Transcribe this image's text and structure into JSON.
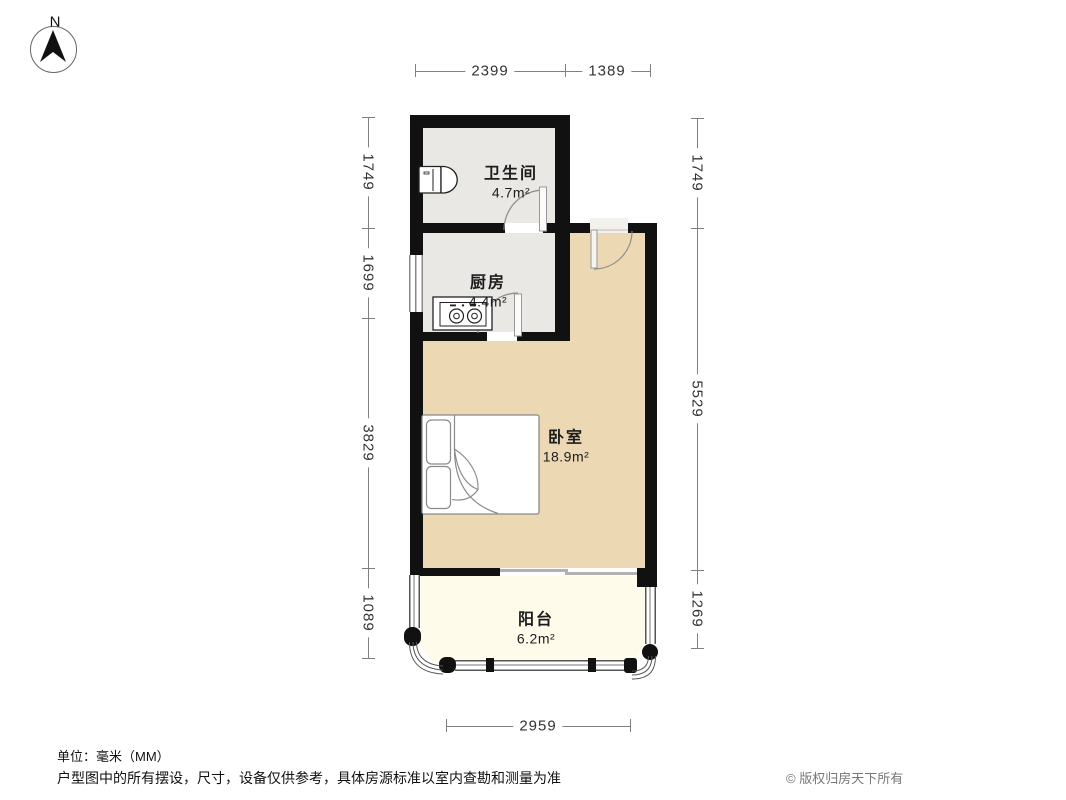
{
  "compass": {
    "north_label": "N"
  },
  "plan": {
    "rooms": [
      {
        "name": "卫生间",
        "area": "4.7m²"
      },
      {
        "name": "厨房",
        "area": "4.4m²"
      },
      {
        "name": "卧室",
        "area": "18.9m²"
      },
      {
        "name": "阳台",
        "area": "6.2m²"
      }
    ],
    "fixtures": [
      "toilet",
      "stove",
      "double-bed"
    ],
    "doors": [
      "bathroom-door",
      "kitchen-door",
      "entrance-door",
      "balcony-sliding-door"
    ]
  },
  "dimensions": {
    "unit": "mm",
    "top": [
      "2399",
      "1389"
    ],
    "left": [
      "1749",
      "1699",
      "3829",
      "1089"
    ],
    "right": [
      "1749",
      "5529",
      "1269"
    ],
    "bottom": [
      "2959"
    ]
  },
  "footer": {
    "unit_note": "单位：毫米（MM）",
    "disclaimer": "户型图中的所有摆设，尺寸，设备仅供参考，具体房源标准以室内查勘和测量为准",
    "copyright": "© 版权归房天下所有"
  },
  "colors": {
    "wall": "#111111",
    "bathroom_floor": "#e9e8e5",
    "kitchen_floor": "#e9e8e5",
    "bedroom_floor": "#ecd9b4",
    "balcony_floor": "#fffbeb",
    "dimension_text": "#333333",
    "copyright_text": "#777777"
  }
}
